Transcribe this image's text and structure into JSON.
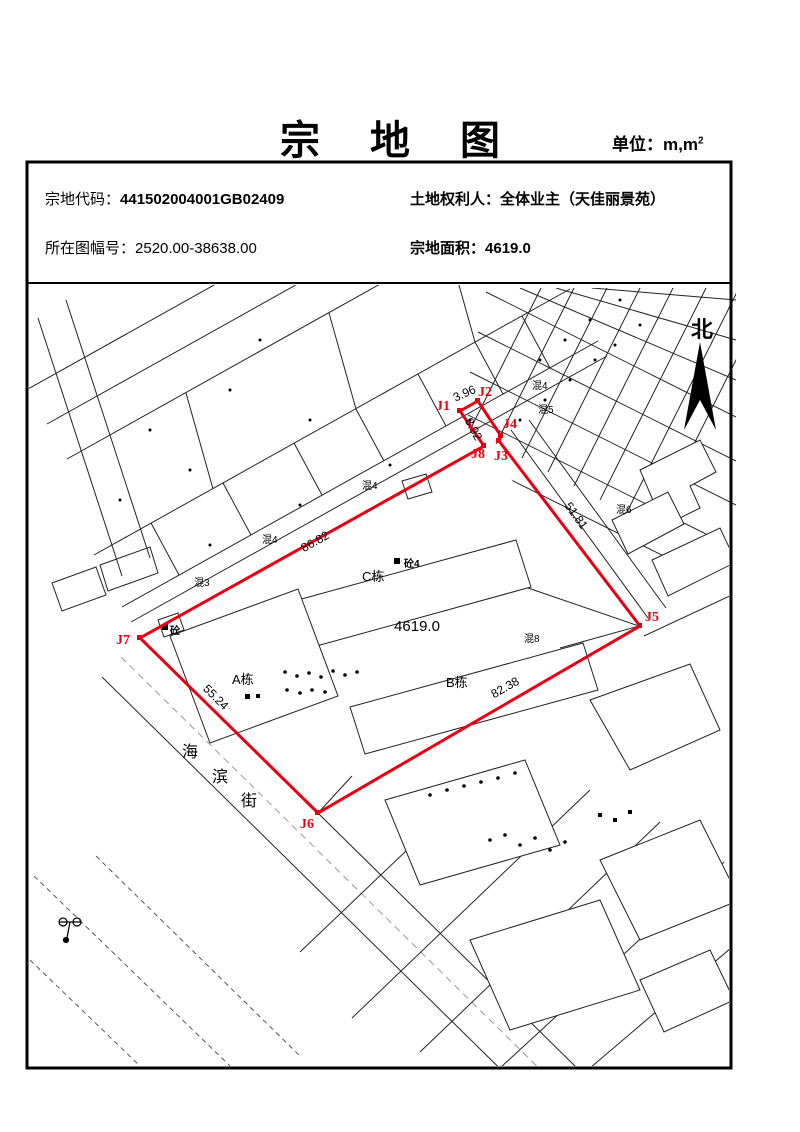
{
  "page": {
    "title": "宗 地 图",
    "unit_prefix": "单位：m,m",
    "unit_sup": "2"
  },
  "info": {
    "parcel_code_label": "宗地代码：",
    "parcel_code": "441502004001GB02409",
    "sheet_no_label": "所在图幅号：",
    "sheet_no": "2520.00-38638.00",
    "owner_label": "土地权利人：",
    "owner": "全体业主（天佳丽景苑）",
    "area_label": "宗地面积：",
    "area": "4619.0"
  },
  "map": {
    "north_label": "北",
    "parcel": {
      "area": "4619.0",
      "points": [
        "J1",
        "J2",
        "J3",
        "J4",
        "J5",
        "J6",
        "J7",
        "J8"
      ],
      "edges": [
        {
          "edge": "J1-J2",
          "value": "3.96"
        },
        {
          "edge": "J8-J1",
          "value": "8.92"
        },
        {
          "edge": "J4-J5",
          "value": "51.81"
        },
        {
          "edge": "J5-J6",
          "value": "82.38"
        },
        {
          "edge": "J6-J7",
          "value": "55.24"
        },
        {
          "edge": "J7-J8",
          "value": "86.82"
        }
      ]
    },
    "buildings": [
      {
        "label": "A栋"
      },
      {
        "label": "B栋"
      },
      {
        "label": "C栋"
      }
    ],
    "annotations": [
      "砼4",
      "混8",
      "混3",
      "混4",
      "混4",
      "混4",
      "混5",
      "混6",
      "砼"
    ],
    "street": {
      "name": "海滨街",
      "chars": [
        "海",
        "滨",
        "街"
      ]
    },
    "colors": {
      "boundary": "#e60012",
      "lines": "#000000"
    }
  }
}
